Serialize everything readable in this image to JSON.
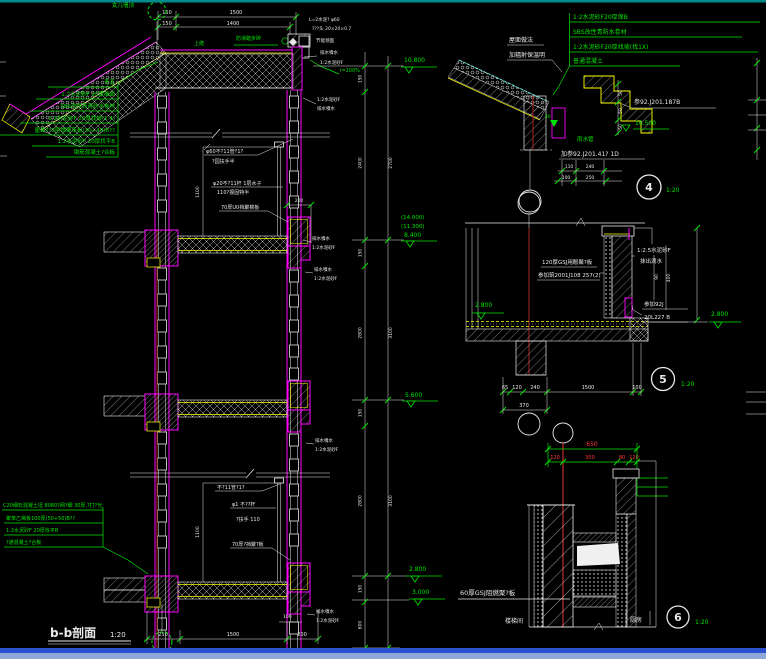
{
  "window": {
    "bg": "#000000",
    "border_top": "#00a8a8",
    "border_bottom": "#2b50d0"
  },
  "colors": {
    "outline": "#ff00ff",
    "hatch": "#e8e8e8",
    "text_green": "#00e400",
    "dim_white": "#e8e8e8",
    "accent_yellow": "#ffff00",
    "dim_red": "#ff3a3a",
    "axis_red": "#8b2020"
  },
  "main": {
    "title": "b-b剖面",
    "title_scale": "1:20",
    "grid_label": "女儿墙顶",
    "roof_walk_note": "上爬",
    "roof_step_note": "防滑踏步砖",
    "roof_specs": [
      "青瓦",
      "1:2水泥砂F 20厚细面",
      "SBS改性沥青防水卷材",
      "1:2水泥砂F 20厚找坡(1:4)",
      "屋面??3阻燃聚苯板(30+40)B??",
      "1:2水泥砂F 20厚找平B",
      "钢筋混凝土?合板"
    ],
    "floor_specs": [
      "C20细石混凝土坦 8080?网?细 30厚,?打?光",
      "聚苯乙烯板100厚(50+50)B??",
      "1:2水泥砂F 20厚找平B",
      "?通混凝土?合板"
    ],
    "parapet_notes": [
      "L=2水泥? φ60",
      "???头 20×20×0.7",
      "节能领面",
      "排水噴水",
      "1:2水泥砂F"
    ],
    "slope_grade": "i=100%",
    "drip_note_a": "排水噴水",
    "drip_note_b": "1:2水泥砂F",
    "rail_notes_upper": [
      "φ60不?11管?1?",
      "?园扶手半",
      "φ20不?11杆 1层水子",
      "110?振固特半",
      "70厚U0挡聚棉板"
    ],
    "rail_notes_lower": [
      "不?11管?1?",
      "φ1 不??杆",
      "?扶手 110",
      "70厚?挡聚?板"
    ],
    "dims": {
      "top_a": "150",
      "top_b": "1500",
      "top_c": "150",
      "top_d": "1400",
      "bottom_a": "250",
      "bottom_b": "1500",
      "bottom_c": "200",
      "rail_height": "1100",
      "upstand_offset": "200",
      "edge": "100"
    },
    "vdims_left": [
      "150",
      "2400",
      "150",
      "2800",
      "150",
      "2800",
      "150",
      "600"
    ],
    "vdims_right": [
      "2700",
      "3100",
      "3100"
    ],
    "elevations": {
      "roof": "10.800",
      "l1a": "(14.000)",
      "l1b": "(11.300)",
      "l1": "8.400",
      "l2": "5.600",
      "l3": "2.800",
      "l3b": "3.000"
    }
  },
  "detail4": {
    "specs": [
      "1:2水泥砂F20厚保B",
      "SBS改性青防水卷材",
      "1:2水泥砂F20厚找坡(找1X)",
      "普通混凝土"
    ],
    "roof_note_a": "屋面做法",
    "roof_note_b": "加辐射保温明",
    "ref_a": "参92.J201.187B",
    "elevation": "16.500",
    "rain_pipe": "雨水管",
    "ref_b": "加参92.J201.41? 1D",
    "step_dim": "50",
    "marker": "40",
    "dims_row1": [
      "110",
      "240"
    ],
    "dims_row2": [
      "100",
      "250"
    ],
    "badge": "4",
    "scale": "1:20"
  },
  "detail5": {
    "board_note_a": "120厚GSJ用酚聚?板",
    "board_note_b": "参加筑2001J108 257(2)",
    "drip_note_a": "1:2.5水泥砂F",
    "drip_note_b": "抹出滴水",
    "vdim_a": "90",
    "vdim_b": "400",
    "ref_a": "参加92J",
    "ref_b": "20L227 B",
    "elev_left": "2.800",
    "elev_right": "2.800",
    "dims_row1": [
      "65",
      "120",
      "240",
      "1500",
      "100"
    ],
    "dim_row2": "370",
    "badge": "5",
    "scale": "1:20"
  },
  "detail6": {
    "dim_total": "650",
    "dims": [
      "120",
      "300",
      "80",
      "120"
    ],
    "board_note": "60厚GSJ阻燃聚?板",
    "room_left": "楼梯间",
    "room_right": "厨房",
    "badge": "6",
    "scale": "1:20"
  }
}
